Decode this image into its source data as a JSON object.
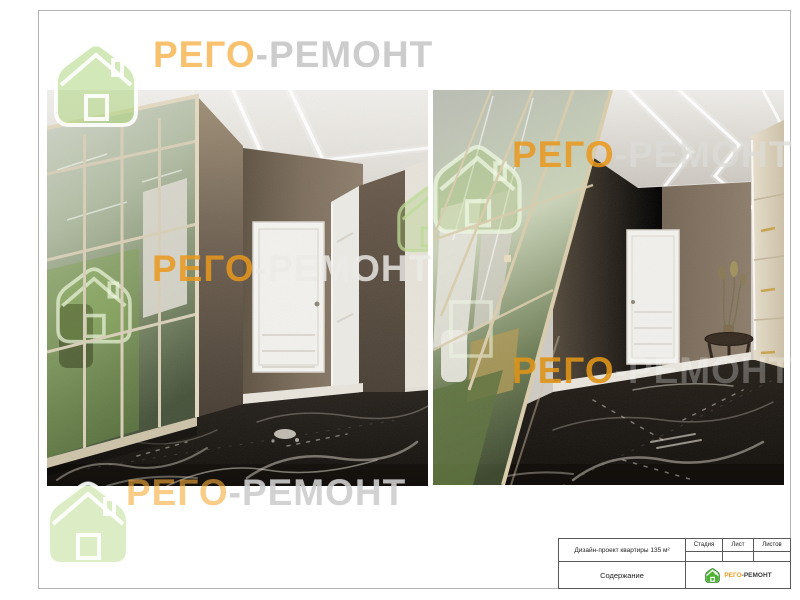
{
  "brand": {
    "part1": "РЕГО",
    "part2": "-РЕМОНТ",
    "orange": "#f0a63a",
    "gray": "#cccccc",
    "logo_green": "#6abf3a"
  },
  "title_block": {
    "project": "Дизайн-проект квартиры 135 м²",
    "stage": "Стадия",
    "sheet": "Лист",
    "sheets": "Листов",
    "content": "Содержание"
  },
  "colors": {
    "wall_brown": "#7a6a58",
    "ceiling": "#e4e1db",
    "marble_floor": "#1a1612",
    "mirror_green": "#8fa07e",
    "frame_champagne": "#d9cdad",
    "door_white": "#f4f3ef"
  }
}
